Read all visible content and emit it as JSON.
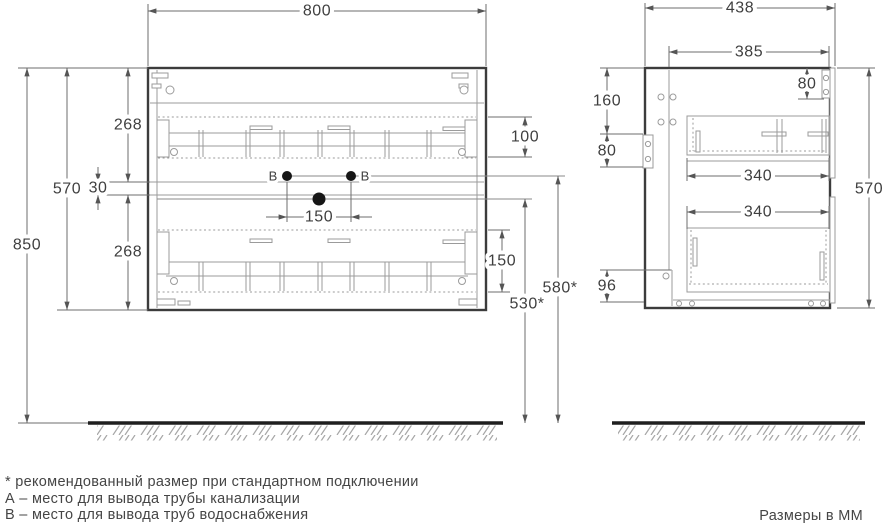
{
  "front_view": {
    "width": "800",
    "total_height": "850",
    "cabinet_height": "570",
    "upper_drawer": "268",
    "lower_drawer": "268",
    "front_gap": "30",
    "upper_inset": "100",
    "lower_inset": "150",
    "hole_spacing": "150",
    "drain_height": "530*",
    "supply_height": "580*",
    "hole_b_left": "B",
    "hole_b_right": "B"
  },
  "side_view": {
    "depth": "438",
    "inner_depth": "385",
    "top_offset": "80",
    "hinge_offset": "160",
    "bracket_height": "80",
    "upper_drawer_depth": "340",
    "lower_drawer_depth": "340",
    "bottom_opening": "96",
    "cabinet_height": "570"
  },
  "footer": {
    "note_recommended": "* рекомендованный размер при стандартном подключении",
    "note_a": "А – место для вывода трубы канализации",
    "note_b": "B – место для вывода труб водоснабжения",
    "units": "Размеры в ММ"
  },
  "colors": {
    "outline": "#3c3c3c",
    "thin_line": "#9b9b9b",
    "dimension_line": "#6e6e6e",
    "text": "#3f3f3f",
    "floor": "#1f1f1f"
  }
}
